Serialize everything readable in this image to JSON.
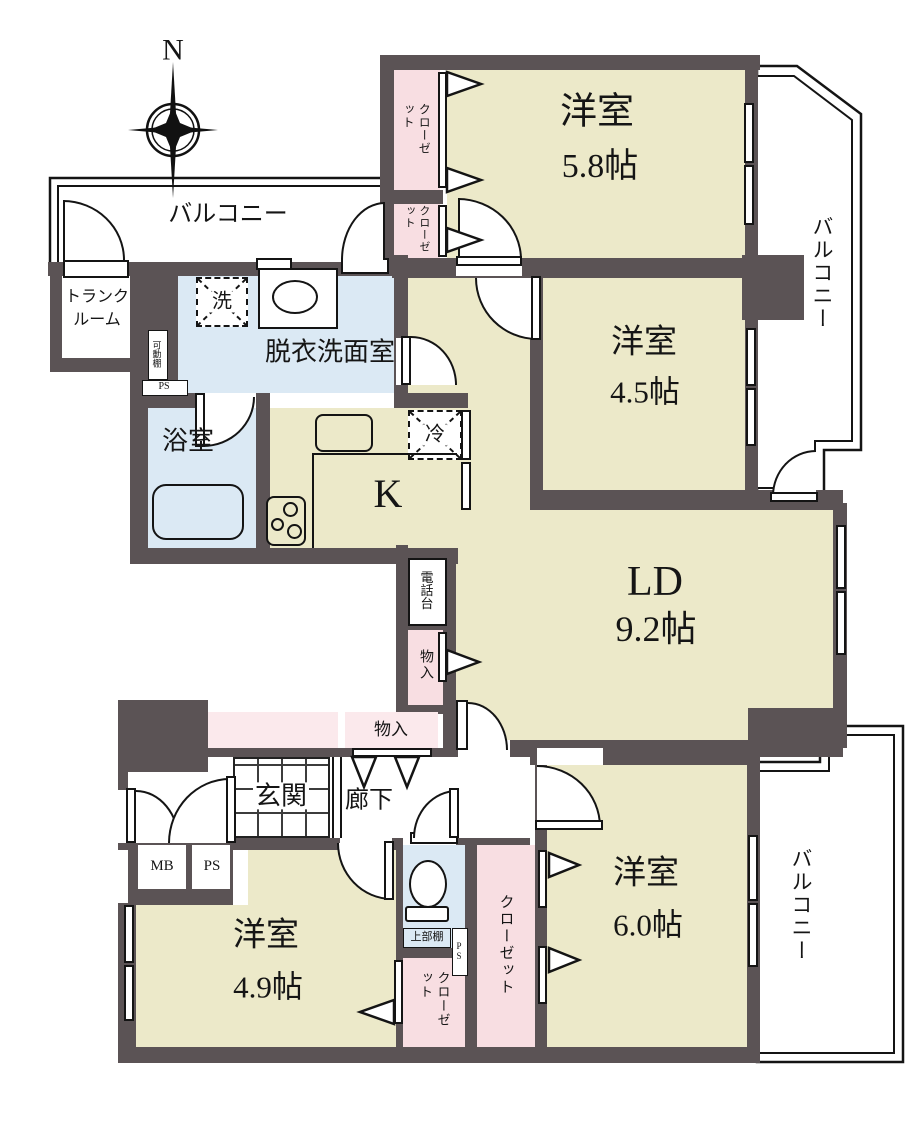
{
  "compass": {
    "north": "N"
  },
  "balconies": {
    "top": "バルコニー",
    "right_top": "バルコニー",
    "right_bottom": "バルコニー"
  },
  "rooms": {
    "west58": {
      "name": "洋室",
      "size": "5.8帖"
    },
    "west45": {
      "name": "洋室",
      "size": "4.5帖"
    },
    "west49": {
      "name": "洋室",
      "size": "4.9帖"
    },
    "west60": {
      "name": "洋室",
      "size": "6.0帖"
    },
    "ld": {
      "name": "LD",
      "size": "9.2帖"
    },
    "kitchen": {
      "name": "K"
    },
    "washroom": {
      "name": "脱衣洗面室"
    },
    "bath": {
      "name": "浴室"
    },
    "genkan": {
      "name": "玄関"
    },
    "hall": {
      "name": "廊下"
    },
    "trunk": {
      "line1": "トランク",
      "line2": "ルーム"
    }
  },
  "storage": {
    "closet_a": "クローゼット",
    "closet_b": "クローゼット",
    "closet_c": "クローゼット",
    "closet_d": "クローゼット",
    "monoire_side": "物入",
    "monoire_front": "物入",
    "phone_stand": "電話台",
    "movable_shelf": "可動棚",
    "upper_shelf": "上部棚"
  },
  "utility": {
    "mb": "MB",
    "ps_main": "PS",
    "ps_side": "PS",
    "ps_mini": "PS",
    "washer": "洗",
    "fridge": "冷"
  },
  "colors": {
    "wall": "#5b5355",
    "room": "#ece9c9",
    "wet": "#dbe9f4",
    "closet": "#f8dee2",
    "line": "#141414"
  }
}
